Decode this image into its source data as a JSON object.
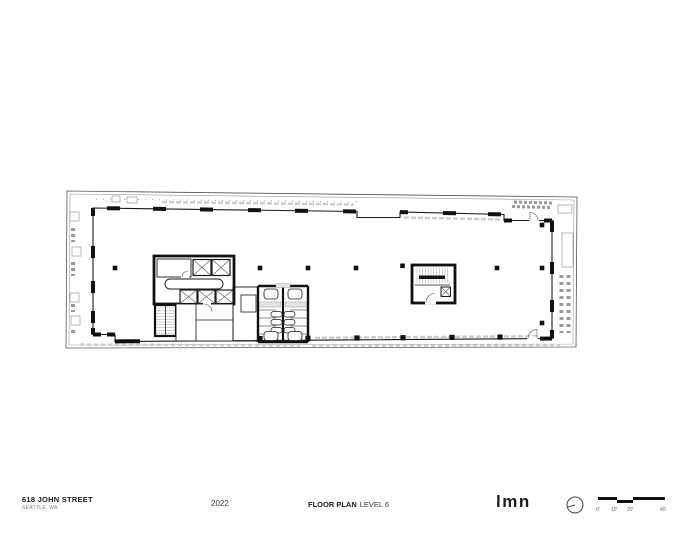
{
  "sheet": {
    "project": {
      "name": "618 JOHN STREET",
      "location": "SEATTLE, WA"
    },
    "year": "2022",
    "title": {
      "label": "FLOOR PLAN",
      "level": "LEVEL 6"
    },
    "logo_text": "LMN",
    "scale_bar": {
      "labels": [
        "0'",
        "10'",
        "20'",
        "40'"
      ]
    },
    "icons": {
      "north": "north-arrow-icon"
    },
    "colors": {
      "ink": "#1a1a1a",
      "wall": "#111111",
      "muted": "#7a7a7a",
      "line": "#999999",
      "faint": "#cccccc"
    }
  }
}
